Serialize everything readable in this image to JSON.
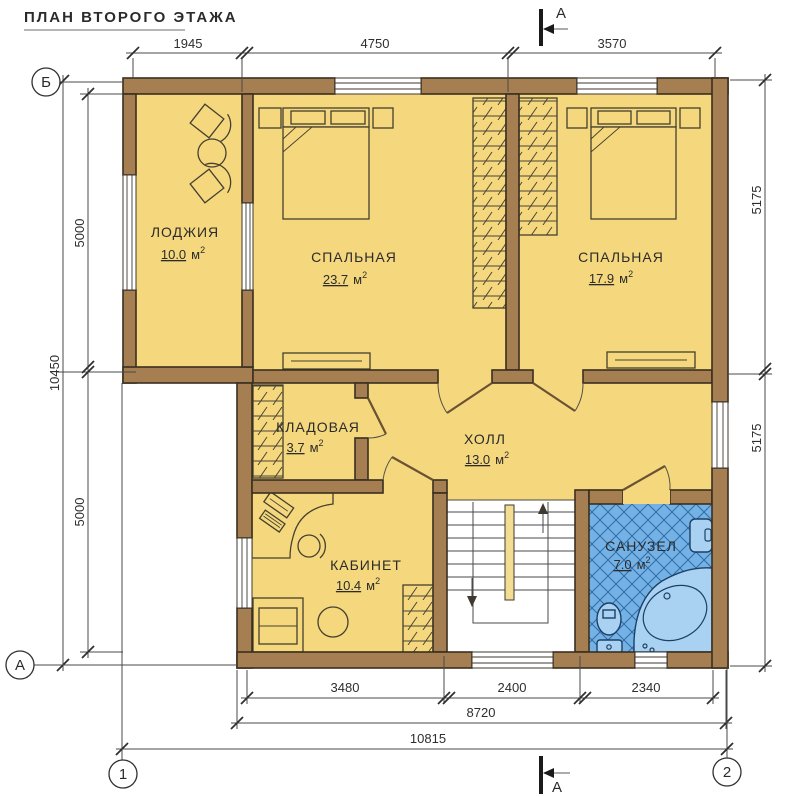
{
  "title": "ПЛАН ВТОРОГО ЭТАЖА",
  "rooms": [
    {
      "name": "ЛОДЖИЯ",
      "area": "10.0"
    },
    {
      "name": "СПАЛЬНАЯ",
      "area": "23.7"
    },
    {
      "name": "СПАЛЬНАЯ",
      "area": "17.9"
    },
    {
      "name": "КЛАДОВАЯ",
      "area": "3.7"
    },
    {
      "name": "ХОЛЛ",
      "area": "13.0"
    },
    {
      "name": "КАБИНЕТ",
      "area": "10.4"
    },
    {
      "name": "САНУЗЕЛ",
      "area": "7.0"
    }
  ],
  "area_unit": "м",
  "area_exp": "2",
  "dims": {
    "top": [
      "1945",
      "4750",
      "3570"
    ],
    "left": {
      "inner": [
        "5000",
        "5000"
      ],
      "outer": "10450"
    },
    "right": [
      "5175",
      "5175"
    ],
    "bottom": {
      "inner": [
        "3480",
        "2400",
        "2340"
      ],
      "mid": "8720",
      "outer": "10815"
    }
  },
  "axes": {
    "left_top": "Б",
    "left_bottom": "А",
    "bottom_left": "1",
    "bottom_right": "2"
  },
  "section_label": "А",
  "colors": {
    "wall": "#a57e52",
    "floor": "#f5d87d",
    "bath_tile": "#74b2e5",
    "line": "#3a2f21"
  }
}
